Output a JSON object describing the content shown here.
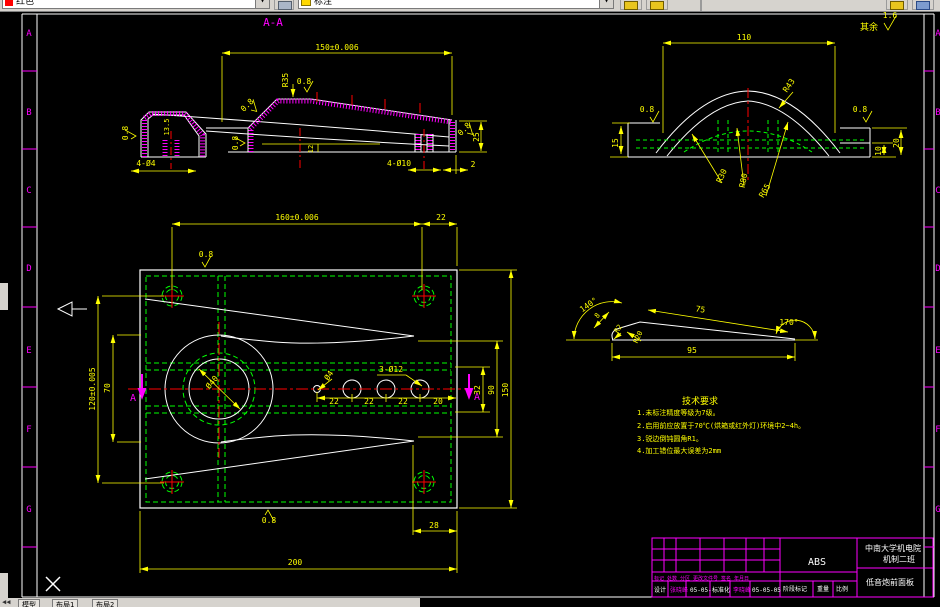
{
  "app": {
    "type": "cad-drawing-editor"
  },
  "toolbar": {
    "color_combo": "红色",
    "layer_combo": "标注",
    "dropdown_glyph": "▾",
    "icons": [
      "color-swatch-icon",
      "layer-bulb-icon",
      "dim-style-icon",
      "dim-update-icon",
      "properties-icon",
      "layers-icon"
    ]
  },
  "status": {
    "nav": "◀◀",
    "tabs": [
      "模型",
      "布局1",
      "布局2"
    ]
  },
  "drawing": {
    "colors": {
      "dim": "#ffff00",
      "outline": "#ffffff",
      "hatch": "#ff00ff",
      "center": "#ff0000",
      "hidden": "#00ff00"
    },
    "zone_letters": [
      "A",
      "B",
      "C",
      "D",
      "E",
      "F",
      "G"
    ],
    "title_block": {
      "material": "ABS",
      "school": "中南大学机电院",
      "class": "机制二班",
      "part_name": "低音炮前面板",
      "header_row": "标记 处数 分区 更改文件号 签名 年月日",
      "designer_label": "设计",
      "designer_sign": "张晓峰",
      "designer_date": "05-05-",
      "standard_label": "标准化",
      "standard_sign": "李晓峰",
      "standard_date": "05-05-05",
      "stage_label": "阶段标记",
      "weight_label": "重量",
      "scale_label": "比例"
    },
    "tech_requirements": {
      "title": "技术要求",
      "items": [
        "1.未标注精度等级为7级。",
        "2.启用前应放置于70℃(烘箱或红外灯)环境中2~4h。",
        "3.锐边倒钝圆角R1。",
        "4.加工错位最大误差为2mm"
      ]
    },
    "annotations": [
      {
        "n": "zone-letter",
        "t": "A",
        "x": 29,
        "y": 36,
        "c": "#ff00ff",
        "s": 9
      },
      {
        "n": "zone-letter",
        "t": "B",
        "x": 29,
        "y": 115,
        "c": "#ff00ff",
        "s": 9
      },
      {
        "n": "zone-letter",
        "t": "C",
        "x": 29,
        "y": 193,
        "c": "#ff00ff",
        "s": 9
      },
      {
        "n": "zone-letter",
        "t": "D",
        "x": 29,
        "y": 271,
        "c": "#ff00ff",
        "s": 9
      },
      {
        "n": "zone-letter",
        "t": "E",
        "x": 29,
        "y": 353,
        "c": "#ff00ff",
        "s": 9
      },
      {
        "n": "zone-letter",
        "t": "F",
        "x": 29,
        "y": 432,
        "c": "#ff00ff",
        "s": 9
      },
      {
        "n": "zone-letter",
        "t": "G",
        "x": 29,
        "y": 512,
        "c": "#ff00ff",
        "s": 9
      },
      {
        "n": "zone-letter",
        "t": "A",
        "x": 938,
        "y": 36,
        "c": "#ff00ff",
        "s": 9
      },
      {
        "n": "zone-letter",
        "t": "B",
        "x": 938,
        "y": 115,
        "c": "#ff00ff",
        "s": 9
      },
      {
        "n": "zone-letter",
        "t": "C",
        "x": 938,
        "y": 193,
        "c": "#ff00ff",
        "s": 9
      },
      {
        "n": "zone-letter",
        "t": "D",
        "x": 938,
        "y": 271,
        "c": "#ff00ff",
        "s": 9
      },
      {
        "n": "zone-letter",
        "t": "E",
        "x": 938,
        "y": 353,
        "c": "#ff00ff",
        "s": 9
      },
      {
        "n": "zone-letter",
        "t": "F",
        "x": 938,
        "y": 432,
        "c": "#ff00ff",
        "s": 9
      },
      {
        "n": "zone-letter",
        "t": "G",
        "x": 938,
        "y": 512,
        "c": "#ff00ff",
        "s": 9
      },
      {
        "n": "section-title",
        "t": "A-A",
        "x": 273,
        "y": 26,
        "c": "#ff00ff",
        "s": 11
      },
      {
        "n": "dim",
        "t": "150±0.006",
        "x": 337,
        "y": 50
      },
      {
        "n": "dim",
        "t": "R35",
        "x": 288,
        "y": 80,
        "r": -90
      },
      {
        "n": "finish",
        "t": "0.8",
        "x": 304,
        "y": 84
      },
      {
        "n": "finish",
        "t": "0.8",
        "x": 128,
        "y": 133,
        "r": -90
      },
      {
        "n": "dim",
        "t": "13.5",
        "x": 169,
        "y": 127,
        "r": -90,
        "s": 7
      },
      {
        "n": "finish",
        "t": "0.8",
        "x": 249,
        "y": 107,
        "r": -45
      },
      {
        "n": "finish",
        "t": "0.8",
        "x": 238,
        "y": 143,
        "r": -90
      },
      {
        "n": "dim",
        "t": "12",
        "x": 313,
        "y": 149,
        "r": -90,
        "s": 7
      },
      {
        "n": "dim",
        "t": "4-Ø4",
        "x": 146,
        "y": 166
      },
      {
        "n": "dim",
        "t": "4-Ø10",
        "x": 399,
        "y": 166
      },
      {
        "n": "dim",
        "t": "2",
        "x": 473,
        "y": 167
      },
      {
        "n": "dim",
        "t": "25",
        "x": 479,
        "y": 137,
        "r": -90
      },
      {
        "n": "finish",
        "t": "0.8",
        "x": 466,
        "y": 131,
        "r": -45
      },
      {
        "n": "dim",
        "t": "110",
        "x": 744,
        "y": 40
      },
      {
        "n": "note",
        "t": "其余",
        "x": 869,
        "y": 30,
        "s": 9
      },
      {
        "n": "finish",
        "t": "1.6",
        "x": 890,
        "y": 18
      },
      {
        "n": "finish",
        "t": "0.8",
        "x": 647,
        "y": 112
      },
      {
        "n": "finish",
        "t": "0.8",
        "x": 860,
        "y": 112
      },
      {
        "n": "dim",
        "t": "15",
        "x": 618,
        "y": 143,
        "r": -90
      },
      {
        "n": "dim",
        "t": "10",
        "x": 881,
        "y": 151,
        "r": -90
      },
      {
        "n": "dim",
        "t": "20",
        "x": 899,
        "y": 143,
        "r": -90
      },
      {
        "n": "dim",
        "t": "R43",
        "x": 791,
        "y": 87,
        "r": -55
      },
      {
        "n": "dim",
        "t": "R30",
        "x": 724,
        "y": 177,
        "r": -65
      },
      {
        "n": "dim",
        "t": "R80",
        "x": 746,
        "y": 181,
        "r": -78
      },
      {
        "n": "dim",
        "t": "R65",
        "x": 767,
        "y": 192,
        "r": -60
      },
      {
        "n": "dim",
        "t": "160±0.006",
        "x": 297,
        "y": 220
      },
      {
        "n": "dim",
        "t": "22",
        "x": 441,
        "y": 220
      },
      {
        "n": "finish",
        "t": "0.8",
        "x": 206,
        "y": 257
      },
      {
        "n": "dim",
        "t": "120±0.005",
        "x": 95,
        "y": 389,
        "r": -90
      },
      {
        "n": "dim",
        "t": "70",
        "x": 110,
        "y": 388,
        "r": -90
      },
      {
        "n": "section-mark",
        "t": "A",
        "x": 133,
        "y": 401,
        "c": "#ff00ff",
        "s": 10
      },
      {
        "n": "section-mark",
        "t": "A",
        "x": 477,
        "y": 400,
        "c": "#ff00ff",
        "s": 10
      },
      {
        "n": "dim",
        "t": "Ø40",
        "x": 214,
        "y": 384,
        "r": -50
      },
      {
        "n": "dim",
        "t": "Ø4",
        "x": 331,
        "y": 377,
        "r": -55
      },
      {
        "n": "dim",
        "t": "3-Ø12",
        "x": 391,
        "y": 372
      },
      {
        "n": "dim",
        "t": "22",
        "x": 334,
        "y": 404
      },
      {
        "n": "dim",
        "t": "22",
        "x": 369,
        "y": 404
      },
      {
        "n": "dim",
        "t": "22",
        "x": 403,
        "y": 404
      },
      {
        "n": "dim",
        "t": "20",
        "x": 438,
        "y": 404
      },
      {
        "n": "dim",
        "t": "32",
        "x": 480,
        "y": 390,
        "r": -90
      },
      {
        "n": "dim",
        "t": "90",
        "x": 494,
        "y": 390,
        "r": -90
      },
      {
        "n": "dim",
        "t": "150",
        "x": 508,
        "y": 390,
        "r": -90
      },
      {
        "n": "finish",
        "t": "0.8",
        "x": 269,
        "y": 523
      },
      {
        "n": "dim",
        "t": "28",
        "x": 434,
        "y": 528
      },
      {
        "n": "dim",
        "t": "200",
        "x": 295,
        "y": 565
      },
      {
        "n": "dim",
        "t": "140°",
        "x": 590,
        "y": 307,
        "r": -35
      },
      {
        "n": "dim",
        "t": "8",
        "x": 599,
        "y": 317,
        "r": -50,
        "s": 7
      },
      {
        "n": "dim",
        "t": "R2",
        "x": 620,
        "y": 330,
        "r": -55,
        "s": 7
      },
      {
        "n": "dim",
        "t": "R20",
        "x": 640,
        "y": 338,
        "r": -65,
        "s": 7
      },
      {
        "n": "dim",
        "t": "75",
        "x": 700,
        "y": 312,
        "r": 9
      },
      {
        "n": "dim",
        "t": "170°",
        "x": 789,
        "y": 325
      },
      {
        "n": "dim",
        "t": "95",
        "x": 692,
        "y": 353
      },
      {
        "n": "tech-title",
        "t": "技术要求",
        "x": 700,
        "y": 404,
        "s": 9
      },
      {
        "n": "tech-line",
        "t": "1.未标注精度等级为7级。",
        "x": 637,
        "y": 415,
        "s": 7,
        "a": "start"
      },
      {
        "n": "tech-line",
        "t": "2.启用前应放置于70℃(烘箱或红外灯)环境中2~4h。",
        "x": 637,
        "y": 428,
        "s": 7,
        "a": "start"
      },
      {
        "n": "tech-line",
        "t": "3.锐边倒钝圆角R1。",
        "x": 637,
        "y": 441,
        "s": 7,
        "a": "start"
      },
      {
        "n": "tech-line",
        "t": "4.加工错位最大误差为2mm",
        "x": 637,
        "y": 453,
        "s": 7,
        "a": "start"
      },
      {
        "n": "tb-material",
        "t": "ABS",
        "x": 817,
        "y": 565,
        "c": "#ffffff",
        "s": 10
      },
      {
        "n": "tb-school",
        "t": "中南大学机电院",
        "x": 893,
        "y": 551,
        "c": "#ffffff",
        "s": 8
      },
      {
        "n": "tb-class",
        "t": "机制二班",
        "x": 899,
        "y": 562,
        "c": "#ffffff",
        "s": 8
      },
      {
        "n": "tb-partname",
        "t": "低音炮前面板",
        "x": 890,
        "y": 585,
        "c": "#ffffff",
        "s": 8
      },
      {
        "n": "tb-header",
        "t": "标记 处数 分区 更改文件号 签名 年月日",
        "x": 654,
        "y": 580,
        "c": "#ff00ff",
        "s": 5,
        "a": "start"
      },
      {
        "n": "tb-cell",
        "t": "设计",
        "x": 654,
        "y": 592,
        "c": "#ffffff",
        "s": 6,
        "a": "start"
      },
      {
        "n": "tb-cell",
        "t": "张晓峰",
        "x": 670,
        "y": 592,
        "c": "#ff00ff",
        "s": 6,
        "a": "start"
      },
      {
        "n": "tb-cell",
        "t": "05-05-",
        "x": 690,
        "y": 592,
        "c": "#ffffff",
        "s": 6,
        "a": "start"
      },
      {
        "n": "tb-cell",
        "t": "标准化",
        "x": 712,
        "y": 592,
        "c": "#ffffff",
        "s": 6,
        "a": "start"
      },
      {
        "n": "tb-cell",
        "t": "李晓峰",
        "x": 733,
        "y": 592,
        "c": "#ff00ff",
        "s": 6,
        "a": "start"
      },
      {
        "n": "tb-cell",
        "t": "05-05-05",
        "x": 752,
        "y": 592,
        "c": "#ffffff",
        "s": 6,
        "a": "start"
      },
      {
        "n": "tb-cell",
        "t": "阶段标记",
        "x": 783,
        "y": 591,
        "c": "#ffffff",
        "s": 6,
        "a": "start"
      },
      {
        "n": "tb-cell",
        "t": "重量",
        "x": 817,
        "y": 591,
        "c": "#ffffff",
        "s": 6,
        "a": "start"
      },
      {
        "n": "tb-cell",
        "t": "比例",
        "x": 836,
        "y": 591,
        "c": "#ffffff",
        "s": 6,
        "a": "start"
      }
    ]
  }
}
